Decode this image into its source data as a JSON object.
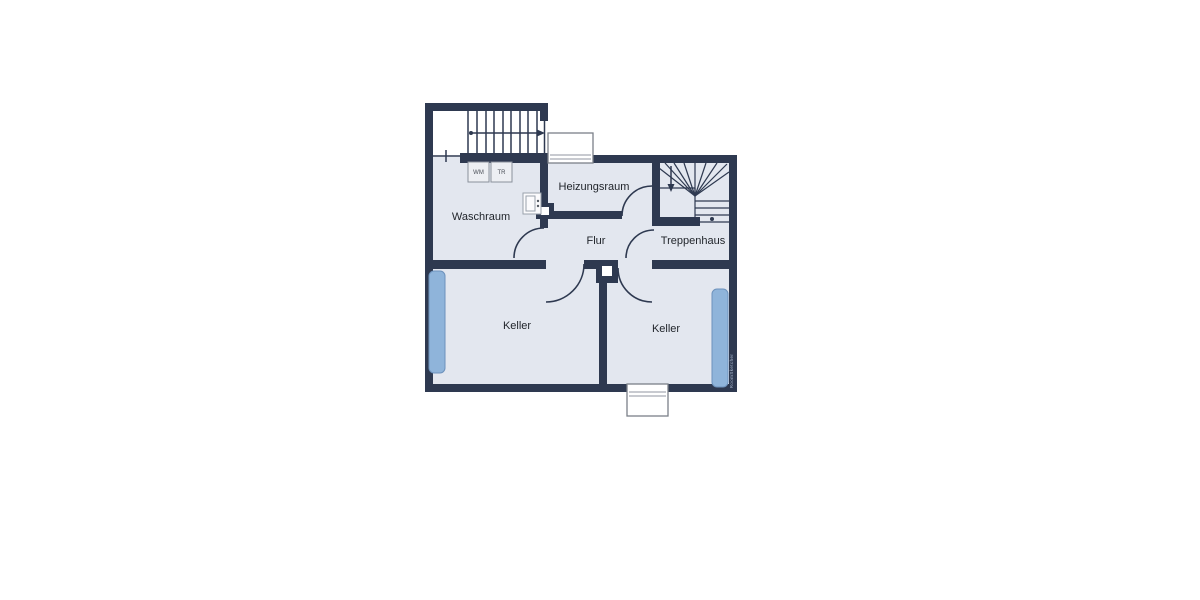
{
  "rooms": {
    "waschraum": {
      "label": "Waschraum"
    },
    "heizungsraum": {
      "label": "Heizungsraum"
    },
    "flur": {
      "label": "Flur"
    },
    "treppenhaus": {
      "label": "Treppenhaus"
    },
    "keller_left": {
      "label": "Keller"
    },
    "keller_right": {
      "label": "Keller"
    }
  },
  "appliances": {
    "washing_machine": "WM",
    "dryer": "TR"
  },
  "icons": {
    "stair_up_arrow": "arrow-right",
    "stair_down_arrow": "arrow-down"
  },
  "watermark": "RoomSketcher",
  "colors": {
    "wall": "#2e3950",
    "room_fill": "#e3e7ef",
    "window_accent": "#8fb4da",
    "background": "#ffffff"
  }
}
